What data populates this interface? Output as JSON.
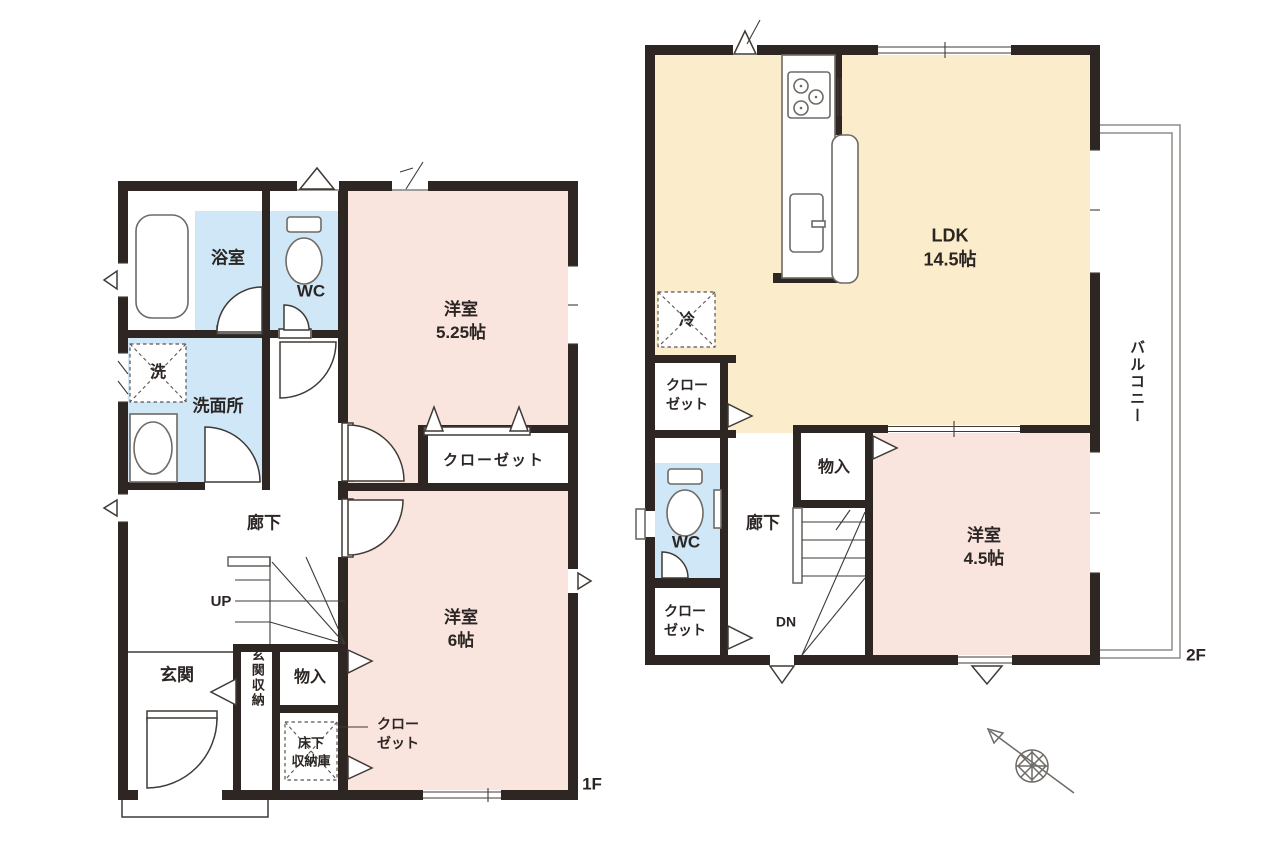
{
  "colors": {
    "wall": "#2e2622",
    "pink": "#f9e4de",
    "blue": "#cfe7f6",
    "cream": "#fbedcb",
    "line": "#3f3a36",
    "text": "#2b2523",
    "bg": "#ffffff"
  },
  "floor1": {
    "label": "1F",
    "bath": "浴室",
    "wc": "WC",
    "laundry": "洗",
    "washroom": "洗面所",
    "hallway": "廊下",
    "stairs": "UP",
    "entrance": "玄関",
    "entrance_storage": "玄関収納",
    "storage": "物入",
    "underfloor_line1": "床下",
    "underfloor_line2": "収納庫",
    "closet": "クローゼット",
    "closet_small_line1": "クロー",
    "closet_small_line2": "ゼット",
    "bedroom1_name": "洋室",
    "bedroom1_size": "5.25帖",
    "bedroom2_name": "洋室",
    "bedroom2_size": "6帖"
  },
  "floor2": {
    "label": "2F",
    "ldk_name": "LDK",
    "ldk_size": "14.5帖",
    "fridge": "冷",
    "closet_upper_line1": "クロー",
    "closet_upper_line2": "ゼット",
    "wc": "WC",
    "closet_lower_line1": "クロー",
    "closet_lower_line2": "ゼット",
    "hallway": "廊下",
    "stairs": "DN",
    "storage": "物入",
    "bedroom_name": "洋室",
    "bedroom_size": "4.5帖",
    "balcony": "バルコニー"
  }
}
